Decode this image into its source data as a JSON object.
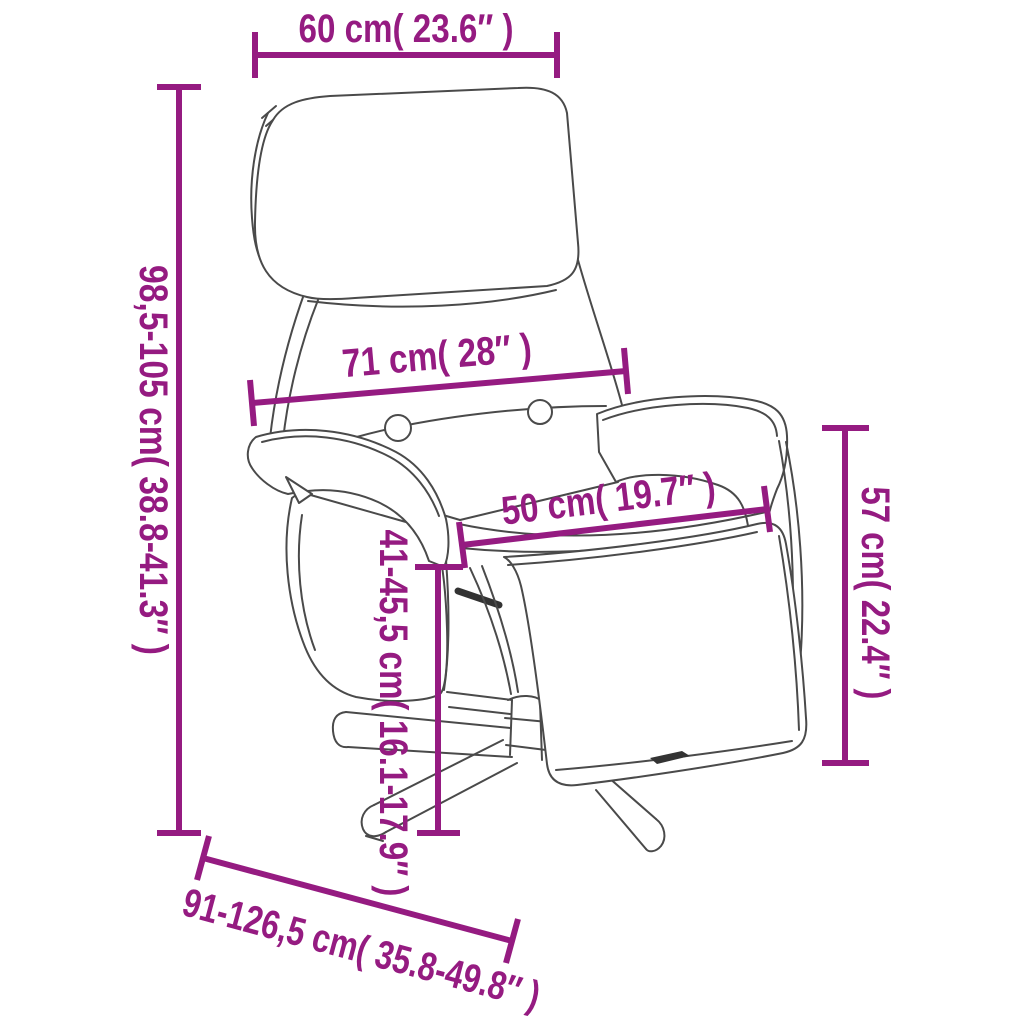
{
  "diagram": {
    "subject": "recliner-chair-with-footrest-dimension-drawing",
    "accent_color": "#951B81",
    "outline_color": "#4a4a4a",
    "background_color": "#ffffff",
    "dimensions": [
      {
        "id": "top-width",
        "label": "60 cm( 23.6″ )",
        "orientation": "horizontal"
      },
      {
        "id": "total-height",
        "label": "98,5-105 cm( 38.8-41.3″ )",
        "orientation": "vertical"
      },
      {
        "id": "backrest-width",
        "label": "71 cm( 28″ )",
        "orientation": "slanted"
      },
      {
        "id": "seat-width",
        "label": "50 cm( 19.7″ )",
        "orientation": "slanted"
      },
      {
        "id": "seat-height",
        "label": "41-45,5 cm( 16.1-17.9″ )",
        "orientation": "vertical"
      },
      {
        "id": "armrest-height",
        "label": "57 cm( 22.4″ )",
        "orientation": "vertical"
      },
      {
        "id": "depth",
        "label": "91-126,5 cm( 35.8-49.8″ )",
        "orientation": "diagonal"
      }
    ]
  }
}
